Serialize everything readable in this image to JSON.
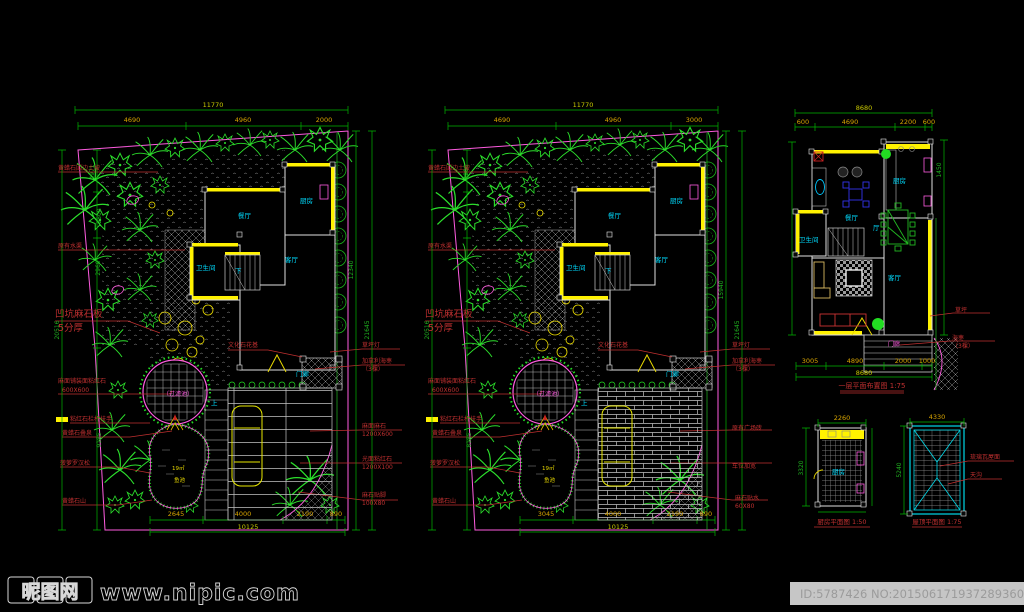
{
  "colors": {
    "background": "#000000",
    "site_boundary": "#ff5ce0",
    "vegetation": "#2ce02c",
    "dimension_line": "#00b400",
    "dimension_text": "#d8a500",
    "annotation_text": "#c03030",
    "room_text": "#00dcff",
    "wall_highlight": "#fff200",
    "roof_border": "#00d8e8"
  },
  "wm": {
    "site": "昵图网",
    "url": "www.nipic.com",
    "id": "ID:5787426 NO:20150617193728936000"
  },
  "a": {
    "top_total": "11770",
    "top_segs": [
      "4690",
      "4960",
      "2000"
    ],
    "bottom_segs": [
      "2645",
      "4000",
      "2190",
      "890"
    ],
    "bottom_total": "10125",
    "left_dims": [
      "4971",
      "2800",
      "2960",
      "20516",
      "9185"
    ],
    "right_dims": [
      "12340",
      "21645"
    ],
    "labels_left": [
      "黄蜡石围边土坡",
      "原有水渠",
      "凹坑麻石板",
      "5分厚",
      "麻面铺装面粘红石",
      "600X600",
      "粘红石栏杆扶手",
      "黄蜡石叠泉",
      "菠萝罗汉松",
      "黄蜡石山"
    ],
    "labels_right": [
      "草坪灯",
      "加拿利海枣",
      "（3棵）",
      "麻面麻石",
      "1200X600",
      "光面粘红石",
      "1200X100",
      "麻石贴脚",
      "100X80"
    ],
    "label_center": "文化石花基",
    "pool": "（过滤池）",
    "pond_area": "19㎡",
    "pond_name": "鱼池",
    "rooms": {
      "dining": "餐厅",
      "kitchen": "厨房",
      "bath": "卫生间",
      "living": "客厅",
      "porch": "门廊"
    },
    "stair_up": "上",
    "stair_down": "下"
  },
  "b": {
    "top_total": "11770",
    "top_segs": [
      "4690",
      "4960",
      "3000"
    ],
    "bottom_segs": [
      "3045",
      "4000",
      "2190",
      "890"
    ],
    "bottom_total": "10125",
    "left_dims": [
      "4900",
      "20516",
      "8185"
    ],
    "right_dims": [
      "15940",
      "21645"
    ],
    "labels_left": [
      "黄蜡石围边土坡",
      "原有水渠",
      "凹坑麻石板",
      "5分厚",
      "麻面铺装面粘红石",
      "600X600",
      "粘红石栏杆扶手",
      "黄蜡石叠泉",
      "菠萝罗汉松",
      "黄蜡石山"
    ],
    "labels_right": [
      "草坪灯",
      "加拿利海枣",
      "（3棵）",
      "原有广场砖",
      "车位加宽",
      "麻石贴水",
      "60X80"
    ],
    "label_center": "文化石花基",
    "pool": "（过滤池）",
    "pond_area": "19㎡",
    "pond_name": "鱼池",
    "rooms": {
      "dining": "餐厅",
      "kitchen": "厨房",
      "bath": "卫生间",
      "living": "客厅",
      "porch": "门廊"
    },
    "stair_up": "上",
    "stair_down": "下"
  },
  "f": {
    "title": "一层平面布置图 1:75",
    "rooms": {
      "dining": "餐厅",
      "hall": "厅",
      "kitchen": "厨房",
      "bath": "卫生间",
      "living": "客厅",
      "porch": "门廊"
    },
    "labels_right": [
      "草坪",
      "海枣",
      "（3棵）"
    ],
    "top_total": "8680",
    "top_segs": [
      "600",
      "4690",
      "2200",
      "600"
    ],
    "bottom_segs": [
      "3005",
      "4890",
      "2000",
      "1000"
    ],
    "bottom_total": "8680",
    "right_dims": [
      "1450"
    ]
  },
  "k": {
    "room": "厨房",
    "title": "厨房平面图 1:50",
    "dim_top": "2260",
    "dim_left": "3320"
  },
  "r": {
    "title": "屋顶平面图 1:75",
    "labels": [
      "琉璃瓦屋面",
      "天沟"
    ],
    "dim_top": "4330",
    "dim_left": "5240"
  }
}
